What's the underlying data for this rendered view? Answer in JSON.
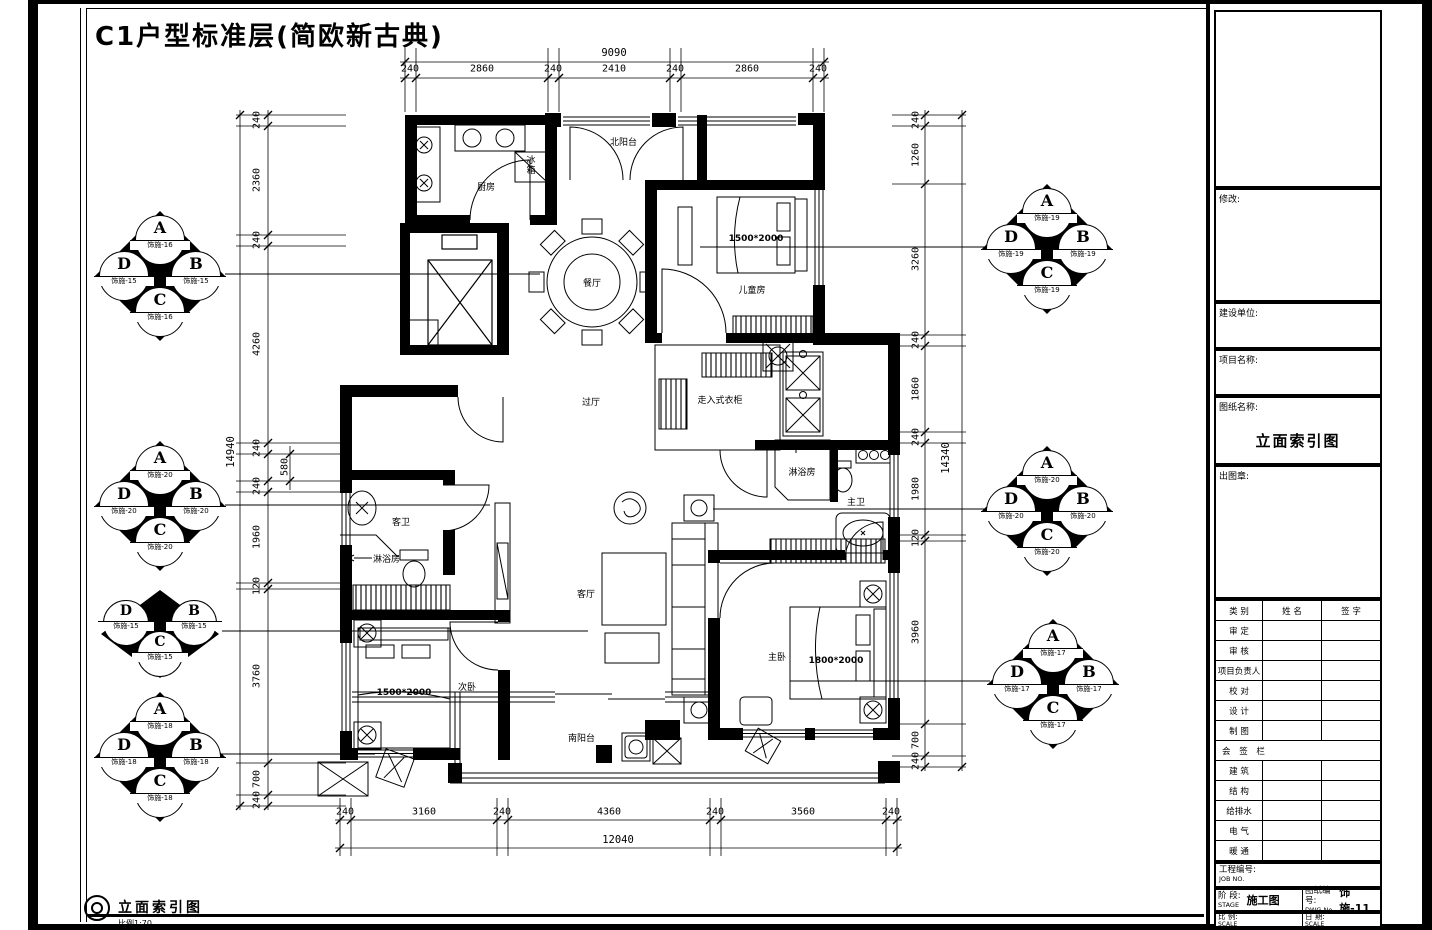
{
  "page_title": "C1户型标准层(简欧新古典)",
  "plan": {
    "rooms": {
      "kitchen": "厨房",
      "north_balcony": "北阳台",
      "dining": "餐厅",
      "kids_room": "儿童房",
      "hallway": "过厅",
      "walkin_closet": "走入式衣柜",
      "shower_room": "淋浴房",
      "master_bath": "主卫",
      "guest_bath": "客卫",
      "guest_shower": "淋浴房",
      "living_room": "客厅",
      "second_bedroom": "次卧",
      "master_bedroom": "主卧",
      "south_balcony": "南阳台",
      "fridge_line1": "冰",
      "fridge_line2": "箱"
    },
    "furniture": {
      "kids_bed": "1500*2000",
      "second_bed": "1500*2000",
      "master_bed": "1800*2000"
    }
  },
  "dimensions": {
    "top": {
      "total": "9090",
      "segments": [
        "240",
        "2860",
        "240",
        "2410",
        "240",
        "2860",
        "240"
      ]
    },
    "bottom": {
      "total": "12040",
      "segments": [
        "240",
        "3160",
        "240",
        "4360",
        "240",
        "3560",
        "240"
      ]
    },
    "left": {
      "total": "14940",
      "segments": [
        "240",
        "2360",
        "240",
        "4260",
        "240",
        "580",
        "240",
        "1960",
        "120",
        "3760",
        "700",
        "240"
      ]
    },
    "right": {
      "total": "14340",
      "segments": [
        "240",
        "1260",
        "3260",
        "240",
        "1860",
        "240",
        "1980",
        "120",
        "3960",
        "700",
        "240"
      ]
    }
  },
  "markers": {
    "letters": {
      "a": "A",
      "b": "B",
      "c": "C",
      "d": "D"
    },
    "top_left": {
      "a": "饰施-16",
      "d": "饰施-15",
      "b": "饰施-15",
      "c": "饰施-16"
    },
    "top_right": {
      "a": "饰施-19",
      "d": "饰施-19",
      "b": "饰施-19",
      "c": "饰施-19"
    },
    "mid_left": {
      "a": "饰施-20",
      "d": "饰施-20",
      "b": "饰施-20",
      "c": "饰施-20"
    },
    "mid_right": {
      "a": "饰施-20",
      "d": "饰施-20",
      "b": "饰施-20",
      "c": "饰施-20"
    },
    "bottom_left_upper": {
      "d": "饰施-15",
      "b": "饰施-15",
      "c": "饰施-15"
    },
    "bottom_left_lower": {
      "a": "饰施-18",
      "d": "饰施-18",
      "b": "饰施-18",
      "c": "饰施-18"
    },
    "bottom_right": {
      "a": "饰施-17",
      "d": "饰施-17",
      "b": "饰施-17",
      "c": "饰施-17"
    }
  },
  "title_block": {
    "revision_label": "修改:",
    "client_label": "建设单位:",
    "project_label": "项目名称:",
    "drawing_label": "图纸名称:",
    "drawing_name": "立面索引图",
    "stamp_label": "出图章:",
    "table": {
      "headers": [
        "类 别",
        "姓 名",
        "签 字"
      ],
      "rows": [
        "审 定",
        "审 核",
        "项目负责人",
        "校 对",
        "设 计",
        "制 图"
      ],
      "sign_section": "会 签 栏",
      "sign_rows": [
        "建 筑",
        "结 构",
        "给排水",
        "电 气",
        "暖 通"
      ]
    },
    "job_no_label": "工程编号:",
    "job_no_en": "JOB NO.",
    "stage_label": "阶 段:",
    "stage_en": "STAGE",
    "stage_value": "施工图",
    "dwg_label": "图纸编号:",
    "dwg_en": "DWG No.",
    "dwg_value": "饰施-11",
    "scale_label": "比 例:",
    "scale_en": "SCALE",
    "date_label": "日 期:",
    "date_value": ""
  },
  "footer": {
    "view_title": "立面索引图",
    "scale_note": "比例1:70"
  }
}
